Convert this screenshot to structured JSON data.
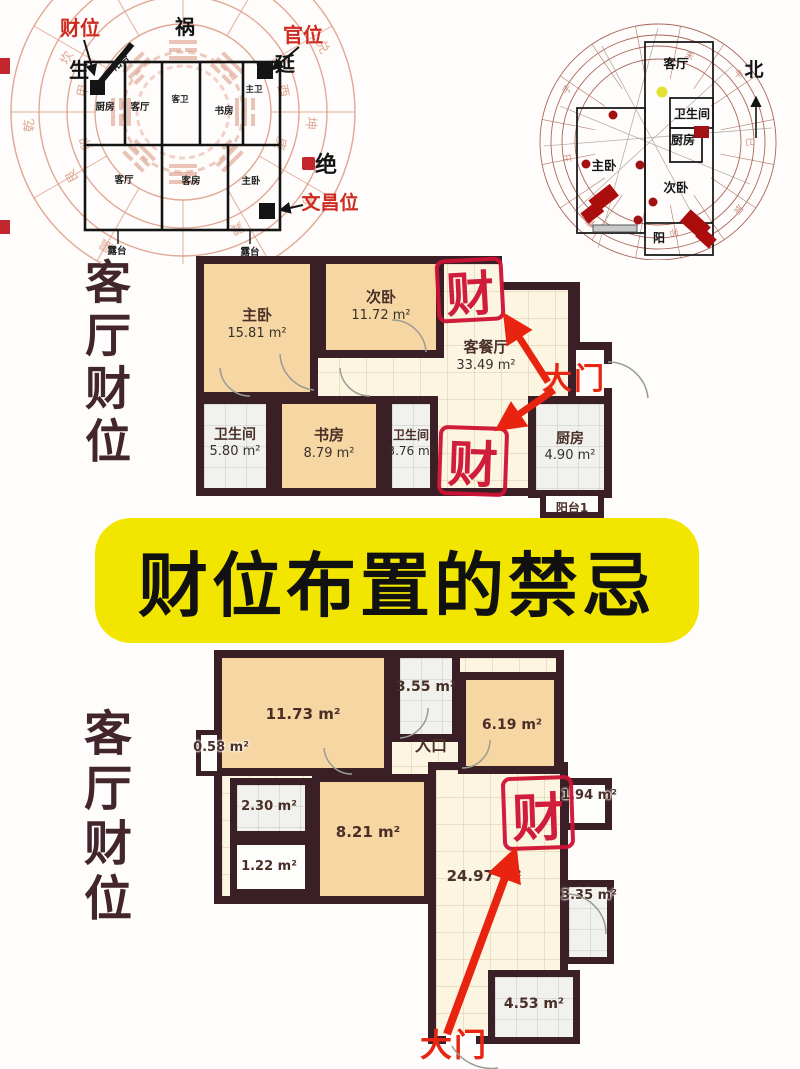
{
  "colors": {
    "wall": "#3a2026",
    "room_tan": "#f6d7a3",
    "room_cream": "#fbf5e2",
    "room_gray": "#f1f1ee",
    "ring_salmon": "#dd9a84",
    "stamp_red": "#cf1234",
    "arrow_red": "#e8230f",
    "banner_yellow": "#f2e600",
    "side_text": "#43252e"
  },
  "banner": {
    "title": "财位布置的禁忌"
  },
  "side_text": {
    "top": "客厅财位",
    "bottom": "客厅财位"
  },
  "bagua": {
    "position_labels": {
      "cai": "财位",
      "huo": "祸",
      "guan": "官位",
      "sheng": "生",
      "yan": "延",
      "jue": "绝",
      "wenchang": "文昌位"
    },
    "room_labels": {
      "yangtai": "阳台",
      "chufang": "厨房",
      "canting": "客厅",
      "kewei": "客卫",
      "shufang": "书房",
      "zhuwei": "主卫",
      "keting": "客厅",
      "kefang": "客房",
      "zhuwo": "主卧",
      "lutai_left": "露台",
      "lutai_right": "露台"
    },
    "ring_chars": [
      "乾",
      "坎",
      "艮",
      "震",
      "巽",
      "离",
      "坤",
      "兑",
      "甲",
      "卯",
      "庚",
      "酉"
    ]
  },
  "compass": {
    "north": "北",
    "room_labels": {
      "keting": "客厅",
      "weishengjian": "卫生间",
      "chufang": "厨房",
      "zhuwo": "主卧",
      "ciwo": "次卧",
      "yang": "阳"
    },
    "ring_chars": [
      "子",
      "丑",
      "寅",
      "卯",
      "辰",
      "巳",
      "午",
      "未"
    ]
  },
  "plan1": {
    "stamp_top": "财",
    "stamp_mid": "财",
    "door": "大门",
    "rooms": {
      "zhuwo": {
        "name": "主卧",
        "area": "15.81 m²"
      },
      "ciwo": {
        "name": "次卧",
        "area": "11.72 m²"
      },
      "kecanting": {
        "name": "客餐厅",
        "area": "33.49 m²"
      },
      "wsj1": {
        "name": "卫生间",
        "area": "5.80 m²"
      },
      "shufang": {
        "name": "书房",
        "area": "8.79 m²"
      },
      "wsj2": {
        "name": "卫生间",
        "area": "3.76 m²"
      },
      "chufang": {
        "name": "厨房",
        "area": "4.90 m²"
      },
      "yangtai": {
        "name": "阳台1"
      }
    }
  },
  "plan2": {
    "stamp": "财",
    "door": "大门",
    "entry": "入口",
    "areas": {
      "a1173": "11.73 m²",
      "a355": "3.55 m²",
      "a619": "6.19 m²",
      "a058": "0.58 m²",
      "a230": "2.30 m²",
      "a821": "8.21 m²",
      "a122": "1.22 m²",
      "a2497": "24.97 m²",
      "a194": "1.94 m²",
      "a335": "3.35 m²",
      "a453": "4.53 m²"
    }
  }
}
